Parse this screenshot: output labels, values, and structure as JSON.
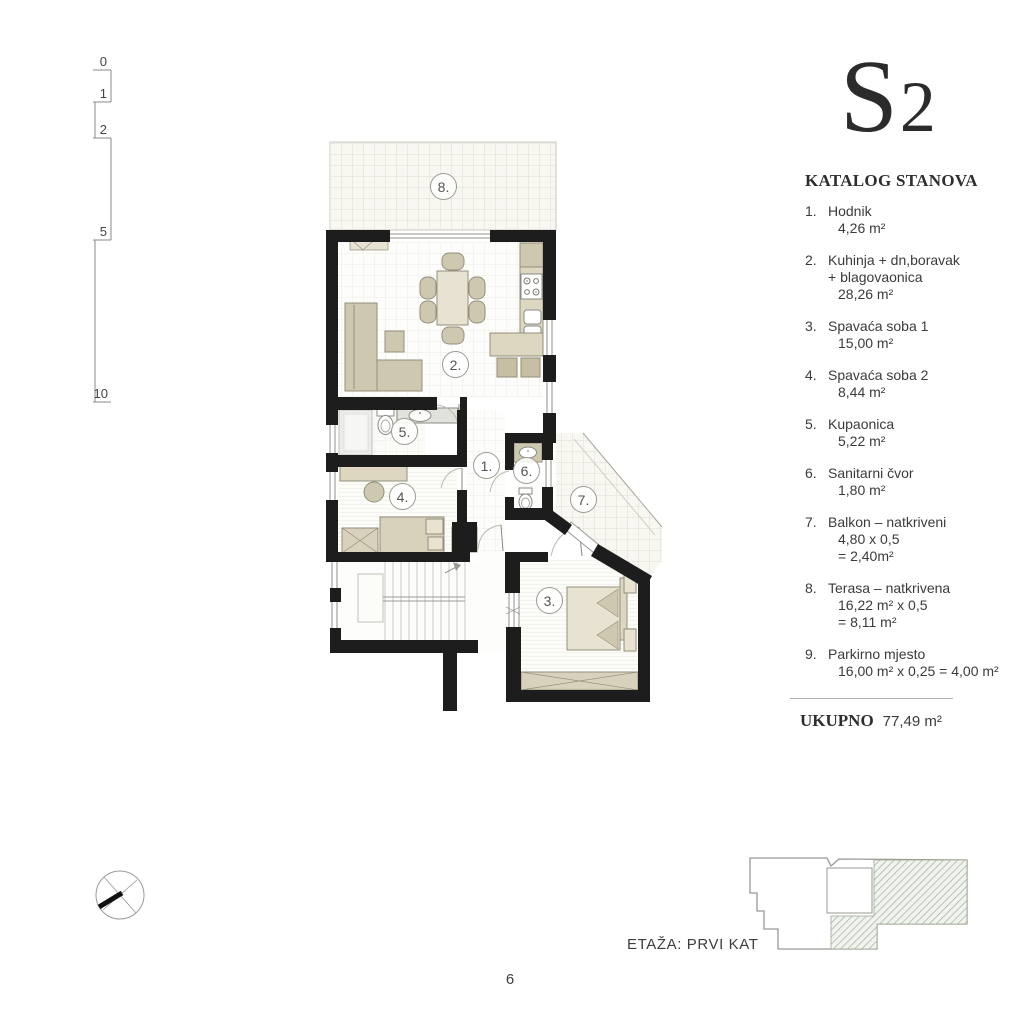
{
  "unit": {
    "code": "S2"
  },
  "catalog": {
    "title": "KATALOG STANOVA",
    "items": [
      {
        "num": "1.",
        "lines": [
          "Hodnik"
        ],
        "values": [
          "4,26 m²"
        ]
      },
      {
        "num": "2.",
        "lines": [
          "Kuhinja + dn,boravak",
          "+ blagovaonica"
        ],
        "values": [
          "28,26 m²"
        ]
      },
      {
        "num": "3.",
        "lines": [
          "Spavaća soba 1"
        ],
        "values": [
          "15,00 m²"
        ]
      },
      {
        "num": "4.",
        "lines": [
          "Spavaća soba 2"
        ],
        "values": [
          "8,44 m²"
        ]
      },
      {
        "num": "5.",
        "lines": [
          "Kupaonica"
        ],
        "values": [
          "5,22 m²"
        ]
      },
      {
        "num": "6.",
        "lines": [
          "Sanitarni čvor"
        ],
        "values": [
          "1,80 m²"
        ]
      },
      {
        "num": "7.",
        "lines": [
          "Balkon – natkriveni"
        ],
        "values": [
          "4,80 x 0,5",
          "= 2,40m²"
        ]
      },
      {
        "num": "8.",
        "lines": [
          "Terasa – natkrivena"
        ],
        "values": [
          "16,22 m² x 0,5",
          "= 8,11 m²"
        ]
      },
      {
        "num": "9.",
        "lines": [
          "Parkirno mjesto"
        ],
        "values": [
          "16,00 m² x 0,25 = 4,00 m²"
        ]
      }
    ],
    "total_label": "UKUPNO",
    "total_value": "77,49 m²"
  },
  "plan": {
    "rooms": {
      "r1": "1.",
      "r2": "2.",
      "r3": "3.",
      "r4": "4.",
      "r5": "5.",
      "r6": "6.",
      "r7": "7.",
      "r8": "8."
    }
  },
  "scale_bar": {
    "labels": [
      "0",
      "1",
      "2",
      "5",
      "10"
    ]
  },
  "footer": {
    "floor_label": "ETAŽA: PRVI KAT",
    "page_number": "6"
  },
  "colors": {
    "wall": "#1d1d1d",
    "furniture": "#cfc8b0",
    "hatch": "#a3b09c"
  }
}
